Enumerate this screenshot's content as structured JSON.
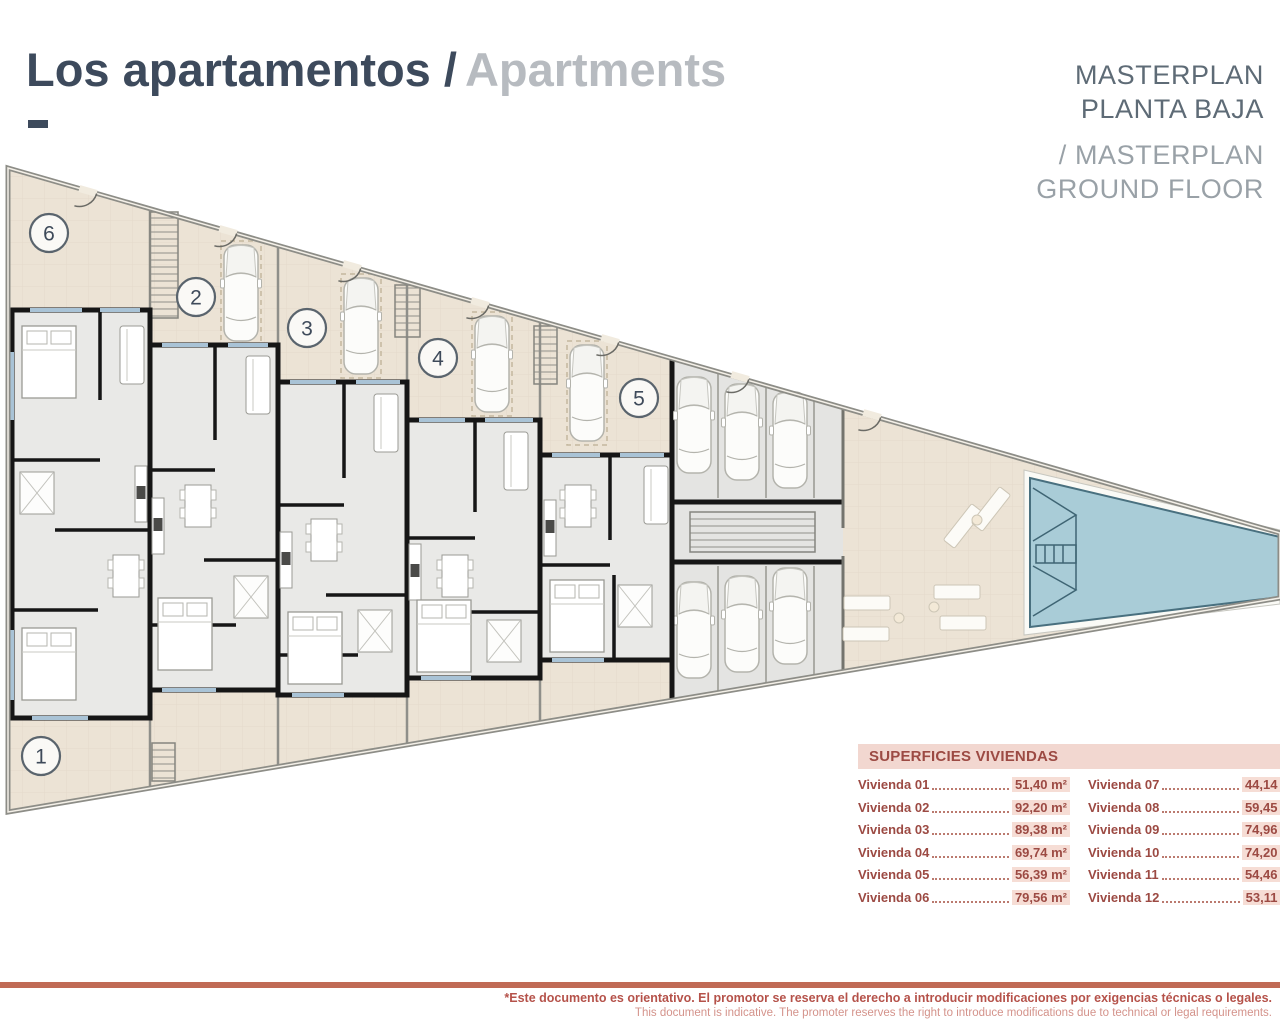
{
  "header": {
    "title_es": "Los apartamentos /",
    "title_en": "Apartments"
  },
  "masterplan": {
    "es_line1": "MASTERPLAN",
    "es_line2": "PLANTA BAJA",
    "en_line1": "/ MASTERPLAN",
    "en_line2": "GROUND FLOOR"
  },
  "plan": {
    "units": [
      "1",
      "2",
      "3",
      "4",
      "5",
      "6"
    ],
    "features": {
      "pool": "swimming-pool-triangular",
      "parking": "parking-stalls-with-cars",
      "stairs": "staircase-hatched",
      "loungers": "sun-loungers",
      "cars": "parked-car-top-view"
    }
  },
  "table": {
    "title": "SUPERFICIES VIVIENDAS",
    "rows": [
      {
        "label": "Vivienda 01",
        "value": "51,40 m²"
      },
      {
        "label": "Vivienda 02",
        "value": "92,20 m²"
      },
      {
        "label": "Vivienda 03",
        "value": "89,38 m²"
      },
      {
        "label": "Vivienda 04",
        "value": "69,74 m²"
      },
      {
        "label": "Vivienda 05",
        "value": "56,39 m²"
      },
      {
        "label": "Vivienda 06",
        "value": "79,56 m²"
      },
      {
        "label": "Vivienda 07",
        "value": "44,14 m²"
      },
      {
        "label": "Vivienda 08",
        "value": "59,45 m²"
      },
      {
        "label": "Vivienda 09",
        "value": "74,96 m²"
      },
      {
        "label": "Vivienda 10",
        "value": "74,20 m²"
      },
      {
        "label": "Vivienda 11",
        "value": "54,46 m²"
      },
      {
        "label": "Vivienda 12",
        "value": "53,11 m²"
      }
    ]
  },
  "footer": {
    "line1": "*Este documento es orientativo. El promotor se reserva el derecho a introducir modificaciones por exigencias técnicas o legales.",
    "line2": "This document is indicative. The promoter reserves the right to introduce modifications due to technical or legal requirements."
  },
  "colors": {
    "title_dark": "#3d4a5c",
    "title_gray": "#b7bbc0",
    "masterplan_dark": "#5e6b76",
    "masterplan_light": "#99a1a7",
    "accent_salmon": "#c06a55",
    "table_maroon": "#9c4a43",
    "table_header_bg": "#f2d7d0",
    "value_highlight_bg": "#f6ddd5",
    "footer_text": "#b5524a",
    "footer_text_light": "#d4938b",
    "pool_blue": "#a9ccd7",
    "site_beige": "#ece3d5",
    "parking_gray": "#e3e3e1",
    "apartment_floor": "#e9e9e7",
    "wall_black": "#161616",
    "window_blue": "#a9c3d6"
  }
}
